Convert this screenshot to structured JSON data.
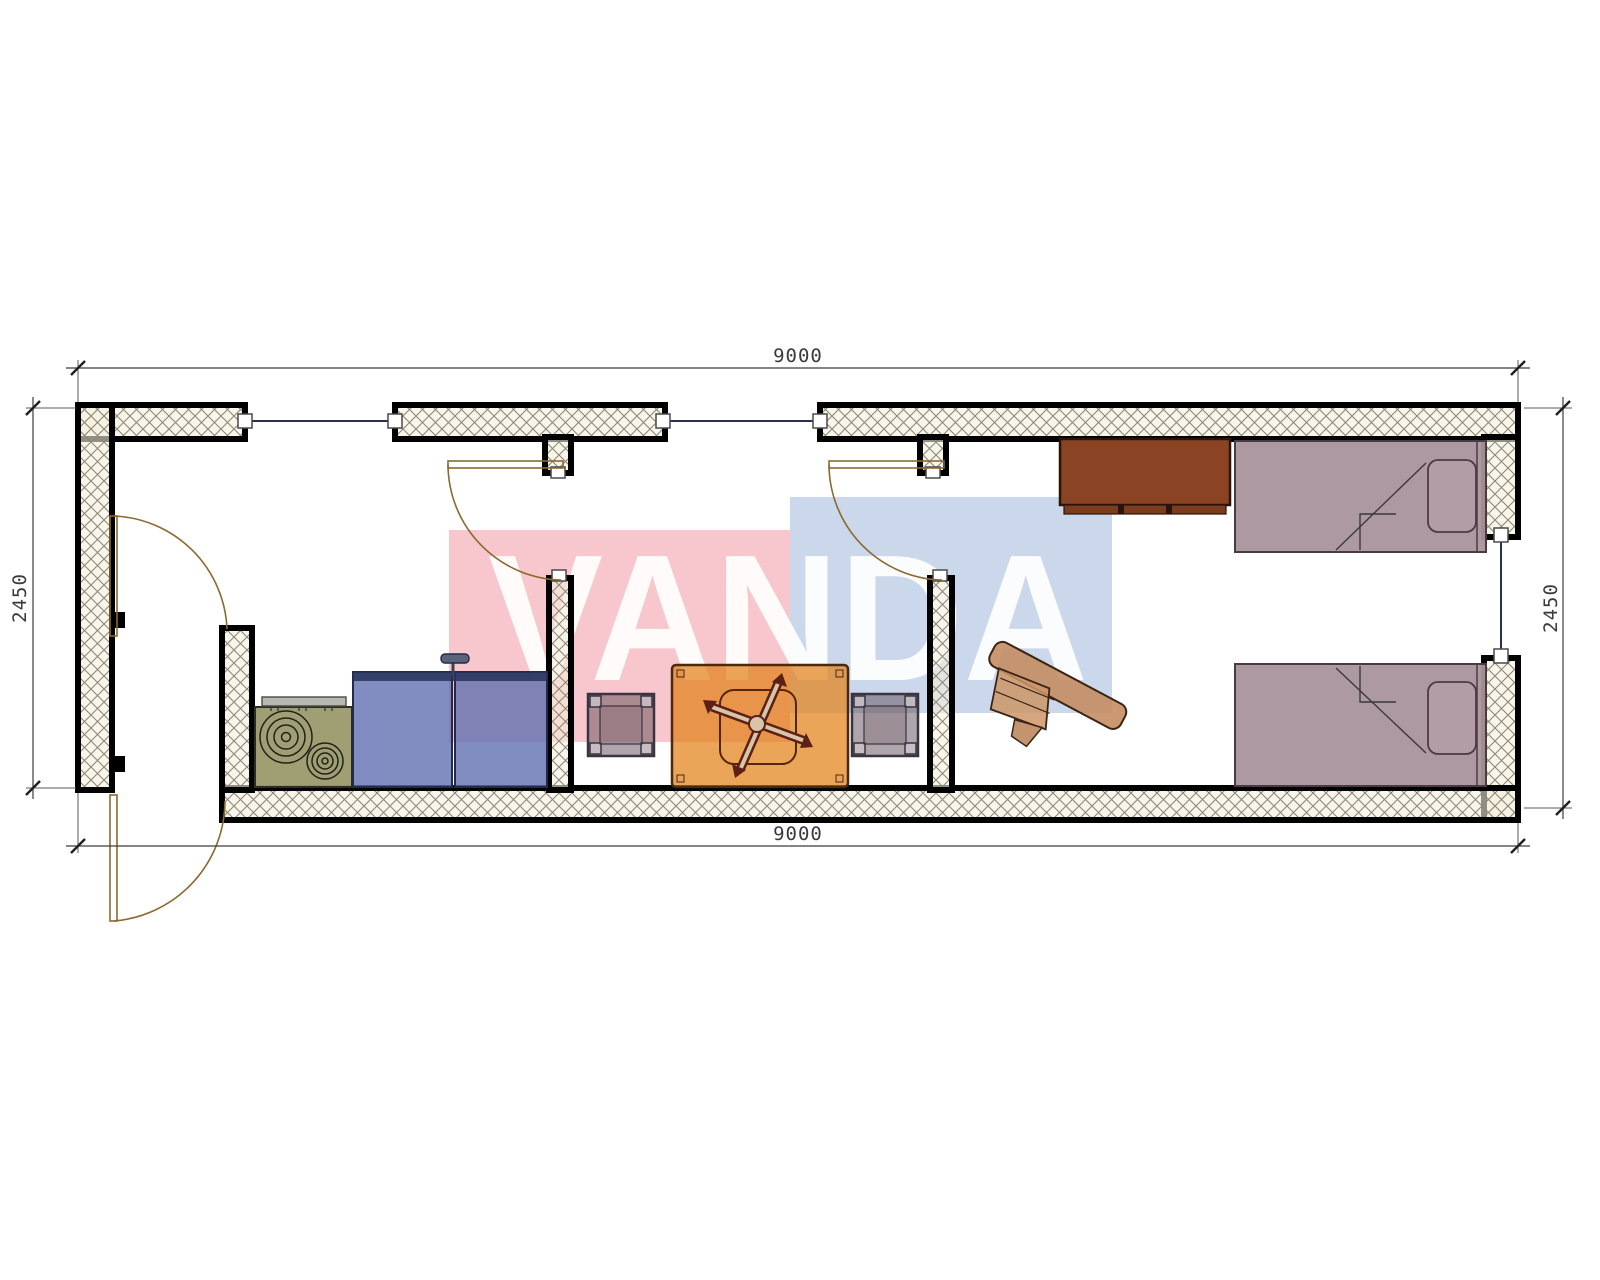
{
  "watermark": {
    "text": "VANDA",
    "pink_color": "#f8c6cd",
    "blue_color": "#cbd8eb",
    "text_color": "#ffffff"
  },
  "dimensions": {
    "top": "9000",
    "bottom": "9000",
    "left": "2450",
    "right": "2450"
  },
  "palette": {
    "wall_hatch": "#f2eedd",
    "wall_hatch_line": "#8f8872",
    "wall_outline": "#000000",
    "window_line": "#26304f",
    "door_line": "#8a6a2f",
    "stove": "#9a9a6b",
    "kitchen_cabinet": "#6170b0",
    "table": "#e28219",
    "stool": "#5f4e58",
    "wardrobe": "#8a4423",
    "bed": "#a9939d",
    "desk_chair": "#c48a5e",
    "dimension_text": "#3a3a3a"
  }
}
